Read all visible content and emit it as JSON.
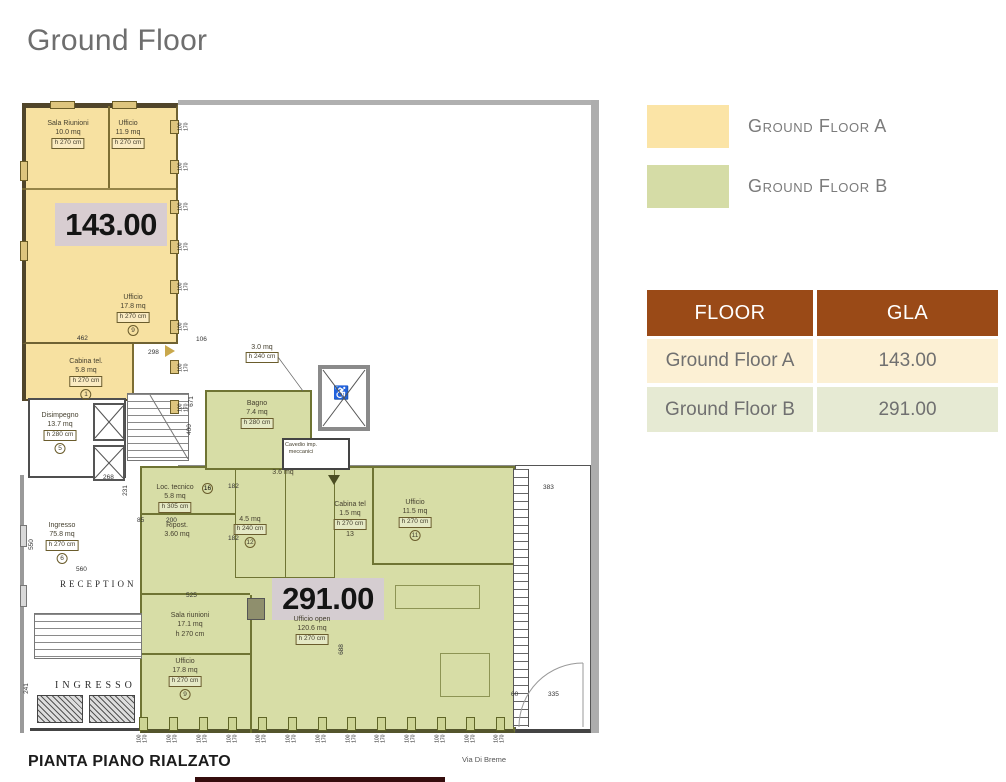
{
  "title": "Ground Floor",
  "legend": [
    {
      "label": "Ground Floor A"
    },
    {
      "label": "Ground Floor B"
    }
  ],
  "table": {
    "col_floor": "FLOOR",
    "col_gla": "GLA",
    "rows": [
      {
        "floor": "Ground Floor A",
        "gla": "143.00"
      },
      {
        "floor": "Ground Floor B",
        "gla": "291.00"
      }
    ]
  },
  "colors": {
    "zone_a_fill": "#F7E1A1",
    "zone_b_fill": "#D7DDA6",
    "legend_a": "#FBE4A6",
    "legend_b": "#D5DCA6",
    "table_header_bg": "#9A4A17",
    "row_a_bg": "#FCF0D4",
    "row_b_bg": "#E6EAD3"
  },
  "plan": {
    "caption": "PIANTA PIANO RIALZATO",
    "street_label": "Via Di Breme",
    "zone_a_total": "143.00",
    "zone_b_total": "291.00",
    "reception": "RECEPTION",
    "ingresso_hall": "INGRESSO",
    "wheelchair_icon": "♿",
    "window_w": "100",
    "window_h": "170",
    "windows": {
      "right": 8,
      "bottom": 13
    },
    "rooms": [
      {
        "name": "Sala Riunioni",
        "area": "10.0 mq",
        "h": "h 270 cm"
      },
      {
        "name": "Ufficio",
        "area": "11.9 mq",
        "h": "h 270 cm"
      },
      {
        "name": "Ufficio",
        "area": "17.8 mq",
        "h": "h 270 cm",
        "num": "9"
      },
      {
        "name": "Cabina tel.",
        "area": "5.8 mq",
        "h": "h 270 cm",
        "num": "1"
      },
      {
        "name": "Disimpegno",
        "area": "13.7 mq",
        "h": "h 280 cm",
        "num": "5"
      },
      {
        "name": "Ingresso",
        "area": "75.8 mq",
        "h": "h 270 cm",
        "num": "6"
      },
      {
        "area": "3.0 mq",
        "h": "h 240 cm"
      },
      {
        "name": "Bagno",
        "area": "7.4 mq",
        "h": "h 280 cm"
      },
      {
        "name": "Cavedio imp. meccanici"
      },
      {
        "name": "Loc. tecnico",
        "area": "5.8 mq",
        "h": "h 305 cm",
        "num": "16"
      },
      {
        "name": "Ripost.",
        "area": "3.60 mq"
      },
      {
        "area": "4.5 mq",
        "h": "h 240 cm",
        "num": "12"
      },
      {
        "area": "3.6 mq"
      },
      {
        "name": "Cabina tel",
        "area": "1.5 mq",
        "h": "h 270 cm",
        "num_plain": "13"
      },
      {
        "name": "Ufficio",
        "area": "11.5 mq",
        "h": "h 270 cm",
        "num": "11"
      },
      {
        "name": "Sala riunioni",
        "area": "17.1 mq",
        "h_plain": "h 270 cm"
      },
      {
        "name": "Ufficio open",
        "area": "120.6 mq",
        "h": "h 270 cm"
      },
      {
        "name": "Ufficio",
        "area": "17.8 mq",
        "h": "h 270 cm",
        "num": "9"
      }
    ],
    "dims": [
      "462",
      "298",
      "268",
      "231",
      "550",
      "560",
      "671",
      "400",
      "106",
      "525",
      "688",
      "241",
      "85",
      "200",
      "182",
      "182",
      "383",
      "60",
      "335"
    ]
  }
}
